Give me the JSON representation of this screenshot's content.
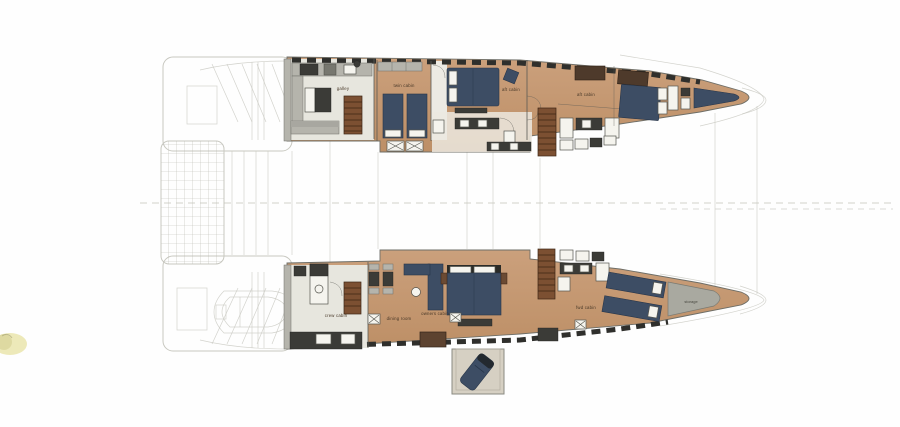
{
  "labels": {
    "galley": "galley",
    "twin_cabin": "twin cabin",
    "aft_cabin_1": "aft cabin",
    "aft_cabin_2": "aft cabin",
    "crew_cabin": "crew cabin",
    "dining_room": "dining room",
    "owners_cabin": "owners cabin",
    "fwd_cabin": "fwd cabin",
    "storage": "storage"
  },
  "colors": {
    "wood": "#c79a74",
    "woodDark": "#b1placeholder",
    "navy": "#3d4d64",
    "navyDark": "#28364a",
    "charcoal": "#3b3b37",
    "counterGray": "#b5b4ac",
    "galleyFloor": "#e7e6de",
    "stairBrown": "#7c5032",
    "rungBrown": "#3c2514",
    "storageGray": "#a9a9a0",
    "faintLine": "#c8c8c0",
    "hullStroke": "#6e6e67",
    "windowDark": "#2f2f2c",
    "fixtureWhite": "#f5f4ee",
    "fixtureStroke": "#55554e",
    "bayTan": "#d6d0c3",
    "blobYellow": "#eae5a9",
    "labelInk": "#463626",
    "wallInk": "#5a5a54"
  }
}
